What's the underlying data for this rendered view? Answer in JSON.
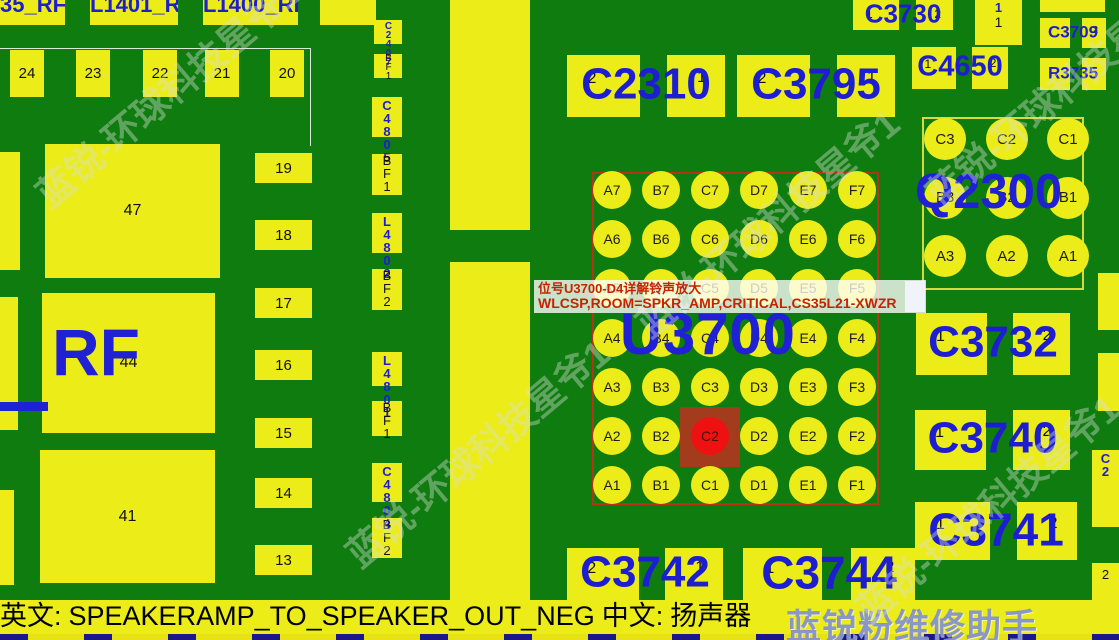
{
  "status_bar": {
    "en_label": "英文:",
    "en_value": "SPEAKERAMP_TO_SPEAKER_OUT_NEG",
    "zh_label": "中文:",
    "zh_value": "扬声器"
  },
  "tooltip": {
    "line1": "位号U3700-D4详解铃声放大",
    "line2": "WLCSP,ROOM=SPKR_AMP,CRITICAL,CS35L21-XWZR"
  },
  "u3700": {
    "ref": "U3700",
    "columns": [
      "A",
      "B",
      "C",
      "D",
      "E",
      "F"
    ],
    "rows": [
      "7",
      "6",
      "5",
      "4",
      "3",
      "2",
      "1"
    ],
    "highlighted_pin": "C2"
  },
  "q2300": {
    "ref": "Q2300",
    "pin_rows": [
      [
        "C3",
        "C2",
        "C1"
      ],
      [
        "B3",
        "B2",
        "B1"
      ],
      [
        "A3",
        "A2",
        "A1"
      ]
    ]
  },
  "components": [
    {
      "ref": "C2310",
      "pins": [
        "2",
        "1"
      ]
    },
    {
      "ref": "C3795",
      "pins": [
        "2",
        "1"
      ]
    },
    {
      "ref": "C3730",
      "pins": [
        "1",
        "2"
      ]
    },
    {
      "ref": "C4650",
      "pins": [
        "1",
        "2"
      ]
    },
    {
      "ref": "C3709",
      "pins": [
        "",
        "2"
      ]
    },
    {
      "ref": "R3735",
      "pins": [
        "",
        ""
      ]
    },
    {
      "ref": "C3732",
      "pins": [
        "1",
        "2"
      ]
    },
    {
      "ref": "C3740",
      "pins": [
        "1",
        "2"
      ]
    },
    {
      "ref": "C3741",
      "pins": [
        "1",
        "2"
      ]
    },
    {
      "ref": "C3742",
      "pins": [
        "2",
        "1"
      ]
    },
    {
      "ref": "C3744",
      "pins": [
        "1",
        "2"
      ]
    }
  ],
  "vertical_components": [
    {
      "ref": "C2407",
      "pin": "BF1"
    },
    {
      "ref": "C4805",
      "pin": "BF1"
    },
    {
      "ref": "L4802",
      "pin": "BF2"
    },
    {
      "ref": "L4801",
      "pin": "BF1"
    },
    {
      "ref": "C4804",
      "pin": "BF2"
    }
  ],
  "left_area": {
    "top_labels": [
      "35_RF",
      "L1401_RF",
      "L1400_RF"
    ],
    "connector_pins": [
      "24",
      "23",
      "22",
      "21",
      "20"
    ],
    "side_pins": [
      "19",
      "18",
      "17",
      "16",
      "15",
      "14",
      "13"
    ],
    "big_pads": [
      "47",
      "44",
      "41"
    ],
    "rf_label": "RF"
  },
  "misc": {
    "right_top_pad_pin_top": "1",
    "right_top_pad_pin_bottom": "1",
    "right_edge_label_fragment": "C2",
    "right_edge_pin_fragment": "2"
  },
  "watermarks": {
    "diagonal": "蓝锐-环球科技星爷1",
    "status": "蓝锐粉维修助手"
  },
  "colors": {
    "board_green": "#0f7c0f",
    "pad_yellow": "#ecec18",
    "label_blue": "#1d1dd2",
    "tooltip_red": "#c42400",
    "highlight_red": "#ee1111",
    "highlight_square": "#a23c1c",
    "chip_outline_red": "#b63317",
    "status_watermark_blue": "#808ece"
  }
}
